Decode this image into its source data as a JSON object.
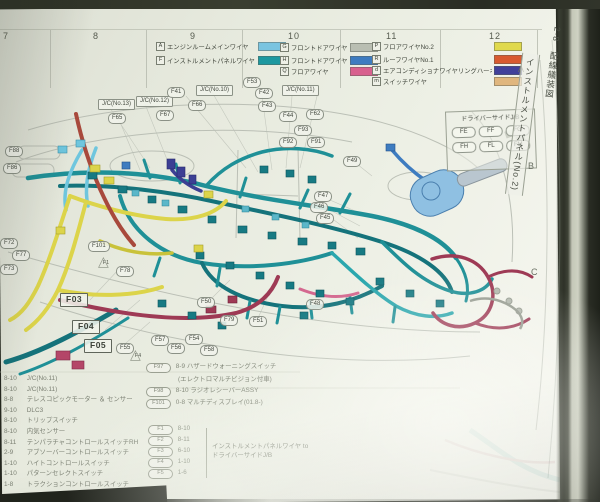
{
  "sidebar_tab": {
    "section": "2-8",
    "doc_title": "配線艤装図",
    "page_title": "インストルメントパネル(No.2)"
  },
  "ruler": {
    "numbers": [
      {
        "t": "7",
        "x": 3
      },
      {
        "t": "8",
        "x": 93
      },
      {
        "t": "9",
        "x": 190
      },
      {
        "t": "10",
        "x": 288
      },
      {
        "t": "11",
        "x": 386
      },
      {
        "t": "12",
        "x": 489
      }
    ]
  },
  "row_markers": [
    {
      "t": "A",
      "x": 518,
      "y": 64
    },
    {
      "t": "B",
      "x": 528,
      "y": 161
    },
    {
      "t": "C",
      "x": 531,
      "y": 267
    }
  ],
  "legend": {
    "col1": [
      {
        "key": "A",
        "label": "エンジンルームメインワイヤ",
        "color": "#7ac4e0"
      },
      {
        "key": "F",
        "label": "インストルメントパネルワイヤ",
        "color": "#1d98a0"
      }
    ],
    "col2": [
      {
        "key": "G",
        "label": "フロントドアワイヤRH",
        "color": "#b9beb2"
      },
      {
        "key": "H",
        "label": "フロントドアワイヤLH",
        "color": "#3e7cc0"
      },
      {
        "key": "Q",
        "label": "フロアワイヤ",
        "color": "#d8608e"
      }
    ],
    "col3": [
      {
        "key": "P",
        "label": "フロアワイヤNo.2",
        "color": "#e0d94c"
      },
      {
        "key": "R",
        "label": "ルーフワイヤNo.1",
        "color": "#d85a30"
      },
      {
        "key": "d",
        "label": "エアコンディショナワイヤリングハーネス",
        "color": "#41409a"
      },
      {
        "key": "m",
        "label": "スイッチワイヤ",
        "color": "#e0b67e"
      }
    ]
  },
  "jb_box": {
    "title": "ドライバーサイドJ/B",
    "cells": [
      "FE",
      "FF",
      "FG",
      "FH",
      "FL",
      "FM"
    ]
  },
  "diagram": {
    "labels": [
      {
        "t": "J/C(No.13)",
        "x": 98,
        "y": 99,
        "cls": "box"
      },
      {
        "t": "J/C(No.12)",
        "x": 136,
        "y": 96,
        "cls": "box"
      },
      {
        "t": "F67",
        "x": 156,
        "y": 110
      },
      {
        "t": "F66",
        "x": 188,
        "y": 100
      },
      {
        "t": "F41",
        "x": 167,
        "y": 87
      },
      {
        "t": "J/C(No.10)",
        "x": 196,
        "y": 85,
        "cls": "box"
      },
      {
        "t": "F53",
        "x": 243,
        "y": 77
      },
      {
        "t": "F42",
        "x": 255,
        "y": 88
      },
      {
        "t": "J/C(No.11)",
        "x": 282,
        "y": 85,
        "cls": "box"
      },
      {
        "t": "F43",
        "x": 258,
        "y": 101
      },
      {
        "t": "F44",
        "x": 279,
        "y": 111
      },
      {
        "t": "F62",
        "x": 306,
        "y": 109
      },
      {
        "t": "F93",
        "x": 294,
        "y": 125
      },
      {
        "t": "F92",
        "x": 279,
        "y": 137
      },
      {
        "t": "F91",
        "x": 307,
        "y": 137
      },
      {
        "t": "F65",
        "x": 108,
        "y": 113
      },
      {
        "t": "F88",
        "x": 5,
        "y": 146
      },
      {
        "t": "F86",
        "x": 3,
        "y": 163
      },
      {
        "t": "F49",
        "x": 343,
        "y": 156
      },
      {
        "t": "F47",
        "x": 314,
        "y": 191
      },
      {
        "t": "F46",
        "x": 310,
        "y": 202
      },
      {
        "t": "F45",
        "x": 316,
        "y": 213
      },
      {
        "t": "F72",
        "x": 0,
        "y": 238
      },
      {
        "t": "F77",
        "x": 12,
        "y": 250
      },
      {
        "t": "F73",
        "x": 0,
        "y": 264
      },
      {
        "t": "F101",
        "x": 88,
        "y": 241
      },
      {
        "t": "F78",
        "x": 116,
        "y": 266
      },
      {
        "t": "F50",
        "x": 197,
        "y": 297
      },
      {
        "t": "F48",
        "x": 306,
        "y": 299
      },
      {
        "t": "F79",
        "x": 220,
        "y": 315
      },
      {
        "t": "F51",
        "x": 249,
        "y": 316
      },
      {
        "t": "F57",
        "x": 151,
        "y": 335
      },
      {
        "t": "F54",
        "x": 185,
        "y": 334
      },
      {
        "t": "F56",
        "x": 167,
        "y": 343
      },
      {
        "t": "F55",
        "x": 116,
        "y": 343
      },
      {
        "t": "F58",
        "x": 200,
        "y": 345
      },
      {
        "t": "F03",
        "x": 60,
        "y": 293,
        "cls": "bigbox"
      },
      {
        "t": "F04",
        "x": 72,
        "y": 320,
        "cls": "bigbox"
      },
      {
        "t": "F05",
        "x": 84,
        "y": 339,
        "cls": "bigbox"
      },
      {
        "t": "F1",
        "x": 97,
        "y": 254,
        "cls": "tri"
      },
      {
        "t": "F4",
        "x": 129,
        "y": 347,
        "cls": "tri"
      }
    ]
  },
  "table_left": {
    "rows": [
      {
        "ref": "8-10",
        "name": "J/C(No.11)"
      },
      {
        "ref": "8-10",
        "name": "J/C(No.11)"
      },
      {
        "ref": "8-8",
        "name": "テレスコピックモーター ＆ センサー"
      },
      {
        "ref": "9-10",
        "name": "DLC3"
      },
      {
        "ref": "8-10",
        "name": "トリップスイッチ"
      },
      {
        "ref": "8-10",
        "name": "内気センサー"
      },
      {
        "ref": "8-11",
        "name": "テンパラチャコントロールスイッチRH"
      },
      {
        "ref": "2-9",
        "name": "アブソーバーコントロールスイッチ"
      },
      {
        "ref": "1-10",
        "name": "ハイトコントロールスイッチ"
      },
      {
        "ref": "1-10",
        "name": "パターンセレクトスイッチ"
      },
      {
        "ref": "1-8",
        "name": "トラクションコントロールスイッチ"
      }
    ]
  },
  "table_right": {
    "r1": {
      "id": "F97",
      "ref": "8-9",
      "name": "ハザードウォーニングスイッチ"
    },
    "note": "(エレクトロマルチビジョン付車)",
    "r2": {
      "id": "F98",
      "ref": "8-10",
      "name": "ラジオレシーバーASSY"
    },
    "r3": {
      "id": "F101",
      "ref": "0-8",
      "name": "マルチディスプレイ(01.8-)"
    },
    "group_items": [
      {
        "id": "F1",
        "ref": "8-10"
      },
      {
        "id": "F2",
        "ref": "8-11"
      },
      {
        "id": "F3",
        "ref": "6-10"
      },
      {
        "id": "F4",
        "ref": "1-10"
      },
      {
        "id": "F5",
        "ref": "1-6"
      }
    ],
    "note_line1": "インストルメントパネルワイヤ to",
    "note_line2": "ドライバーサイドJ/B"
  },
  "palette": {
    "teal_harness": "#1f9097",
    "cyan_wire": "#6fc6de",
    "yellow_wire": "#dcd44a",
    "pink_wire": "#d4688f",
    "crimson_wire": "#9e3a55",
    "redbrown_wire": "#a8493c",
    "navy_wire": "#3c3f94",
    "blue_wire": "#3e7cc0",
    "panel_line": "#b3b8ae",
    "page_bg": "#ecefe4"
  }
}
